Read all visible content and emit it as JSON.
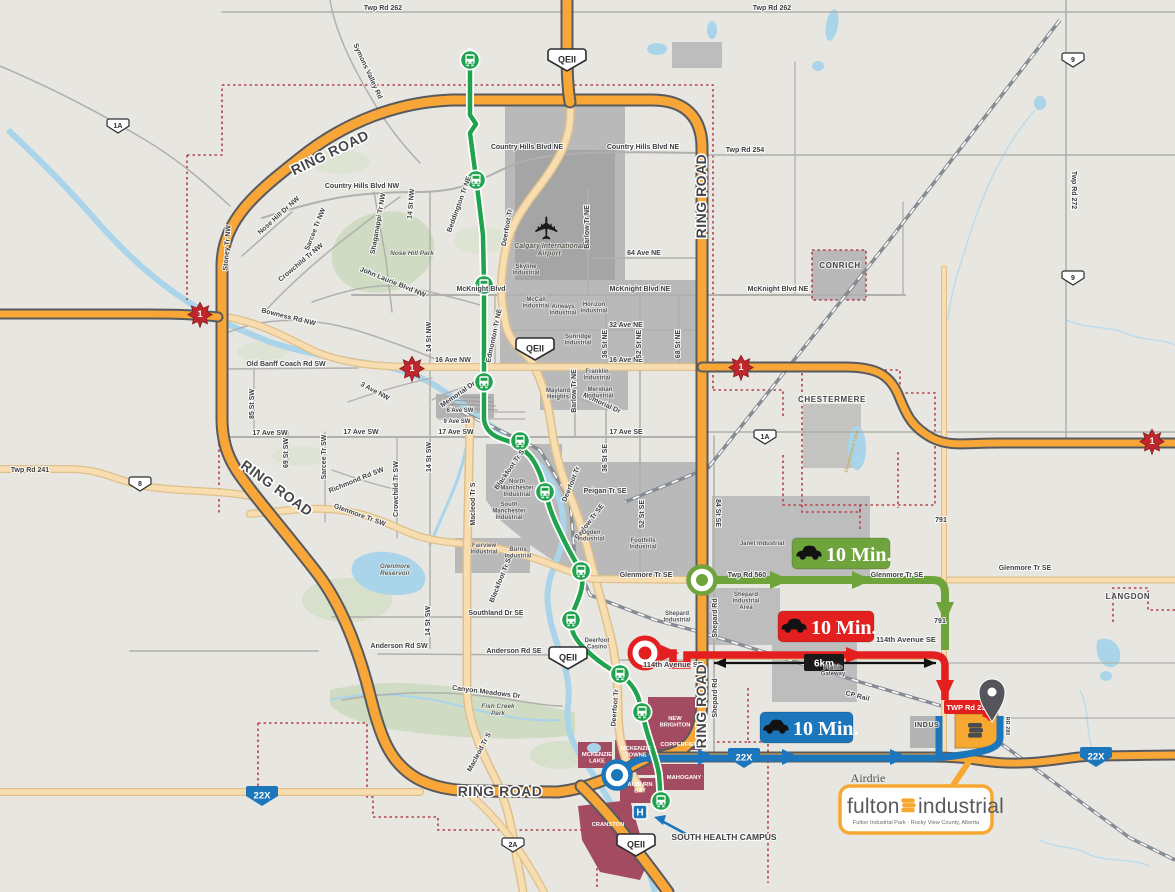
{
  "shields": {
    "qeii": "QEII",
    "hwy1": "1",
    "hwy1a": "1A",
    "hwy8": "8",
    "hwy9": "9",
    "hwy2a": "2A",
    "hwy22x": "22X",
    "hwy791": "791"
  },
  "roads": {
    "ring_road": "RING ROAD",
    "twp_rd_262": "Twp Rd 262",
    "twp_rd_254": "Twp Rd 254",
    "twp_rd_272": "Twp Rd 272",
    "twp_rd_241": "Twp Rd 241",
    "twp_rd_560": "Twp Rd 560",
    "twp_rd_230": "TWP Rd 230",
    "rr_280": "RR 280",
    "symons_valley_rd": "Symons Valley Rd",
    "country_hills_blvd_nw": "Country Hills Blvd NW",
    "country_hills_blvd_ne": "Country Hills Blvd NE",
    "nose_hill_dr_nw": "Nose Hill Dr NW",
    "sarcee_tr_nw": "Sarcee Tr NW",
    "crowchild_tr_nw": "Crowchild Tr NW",
    "shaganappi_tr_nw": "Shaganappi Tr NW",
    "14_st_nw": "14 St NW",
    "john_laurie_blvd_nw": "John Laurie Blvd NW",
    "beddington_tr_ne": "Beddington Tr NE",
    "stoney_tr_nw": "Stoney Tr NW",
    "bowness_rd_nw": "Bowness Rd NW",
    "old_banff_coach_rd_sw": "Old Banff Coach Rd SW",
    "mcknight_blvd": "McKnight Blvd",
    "mcknight_blvd_ne": "McKnight Blvd NE",
    "16_ave_nw": "16 Ave NW",
    "16_ave_ne": "16 Ave NE",
    "3_ave_nw": "3 Ave NW",
    "memorial_dr": "Memorial Dr",
    "6_ave_sw": "6 Ave SW",
    "9_ave_sw": "9 Ave SW",
    "17_ave_sw": "17 Ave SW",
    "17_ave_se": "17 Ave SE",
    "85_st_sw": "85 St SW",
    "69_st_sw": "69 St SW",
    "sarcee_tr_sw": "Sarcee Tr SW",
    "richmond_rd_sw": "Richmond Rd SW",
    "crowchild_tr_sw": "Crowchild Tr SW",
    "14_st_sw": "14 St SW",
    "edmonton_tr_ne": "Edmonton Tr NE",
    "deerfoot_tr": "Deerfoot Tr",
    "barlow_tr_ne": "Barlow Tr NE",
    "barlow_tr_se": "Barlow Tr SE",
    "32_ave_ne": "32 Ave NE",
    "64_ave_ne": "64 Ave NE",
    "36_st_ne": "36 St NE",
    "52_st_ne": "52 St NE",
    "68_st_ne": "68 St NE",
    "36_st_se": "36 St SE",
    "52_st_se": "52 St SE",
    "84_st_se": "84 St SE",
    "blackfoot_tr_s": "Blackfoot Tr S",
    "blackfoot_tr_se": "Blackfoot Tr SE",
    "peigan_tr_se": "Peigan Tr SE",
    "macleod_tr_s": "Macleod Tr S",
    "glenmore_tr_sw": "Glenmore Tr SW",
    "glenmore_tr_se": "Glenmore Tr SE",
    "southland_dr_se": "Southland Dr SE",
    "anderson_rd_sw": "Anderson Rd SW",
    "anderson_rd_se": "Anderson Rd SE",
    "canyon_meadows_dr": "Canyon Meadows Dr",
    "shepard_rd": "Shepard Rd",
    "cp_rail": "CP Rail",
    "114th_avenue_se": "114th Avenue SE"
  },
  "areas": {
    "nose_hill_park": "Nose Hill Park",
    "fish_creek_park": "Fish Creek\nPark",
    "glenmore_reservoir": "Glenmore\nReservoir",
    "airport": "Calgary International\nAirport",
    "skyline": "Skyline\nIndustrial",
    "mccall": "McCall\nIndustrial",
    "airways": "Airways\nIndustrial",
    "horizon": "Horizon\nIndustrial",
    "sunridge": "Sunridge\nIndustrial",
    "franklin": "Franklin\nIndustrial",
    "meridian": "Meridian\nIndustrial",
    "mayland_heights": "Mayland\nHeights",
    "north_manchester": "North\nManchester\nIndustrial",
    "south_manchester": "South\nManchester\nIndustrial",
    "fairview": "Fairview\nIndustrial",
    "burns": "Burns\nIndustrial",
    "ogden": "Ogden\nIndustrial",
    "foothills": "Foothills\nIndustrial",
    "shepard": "Shepard\nIndustrial",
    "shepard_area": "Shepard\nIndustrial\nArea",
    "janet": "Janet Industrial",
    "prairie_gateway": "Prairie\nGateway",
    "deerfoot_casino": "Deerfoot\nCasino"
  },
  "places": {
    "conrich": "CONRICH",
    "chestermere": "CHESTERMERE",
    "langdon": "LANGDON",
    "indus": "INDUS",
    "airdrie": "Airdrie",
    "chestermere_lake": "Chestermere Lake"
  },
  "communities": {
    "new_brighton": "NEW\nBRIGHTON",
    "copperfield": "COPPERFIELD",
    "mckenzie_towne": "MCKENZIE\nTOWNE",
    "mckenzie_lake": "MCKENZIE\nLAKE",
    "mahogany": "MAHOGANY",
    "auburn_bay": "AUBURN\nBAY",
    "cranston": "CRANSTON"
  },
  "poi": {
    "south_health_campus": "SOUTH HEALTH CAMPUS",
    "hospital": "H"
  },
  "icons": {
    "airplane": "✈"
  },
  "routes": {
    "green": {
      "label": "10 Min.",
      "color": "#6fa33c"
    },
    "red": {
      "label": "10 Min.",
      "color": "#e3201f"
    },
    "blue": {
      "label": "10 Min.",
      "color": "#1b76bc"
    },
    "transit_color": "#21a24c",
    "distance": "6km"
  },
  "logo": {
    "word1": "fulton",
    "word2": "industrial",
    "tagline": "Fulton Industrial Park - Rocky View County, Alberta",
    "brand_orange": "#f6a831"
  }
}
